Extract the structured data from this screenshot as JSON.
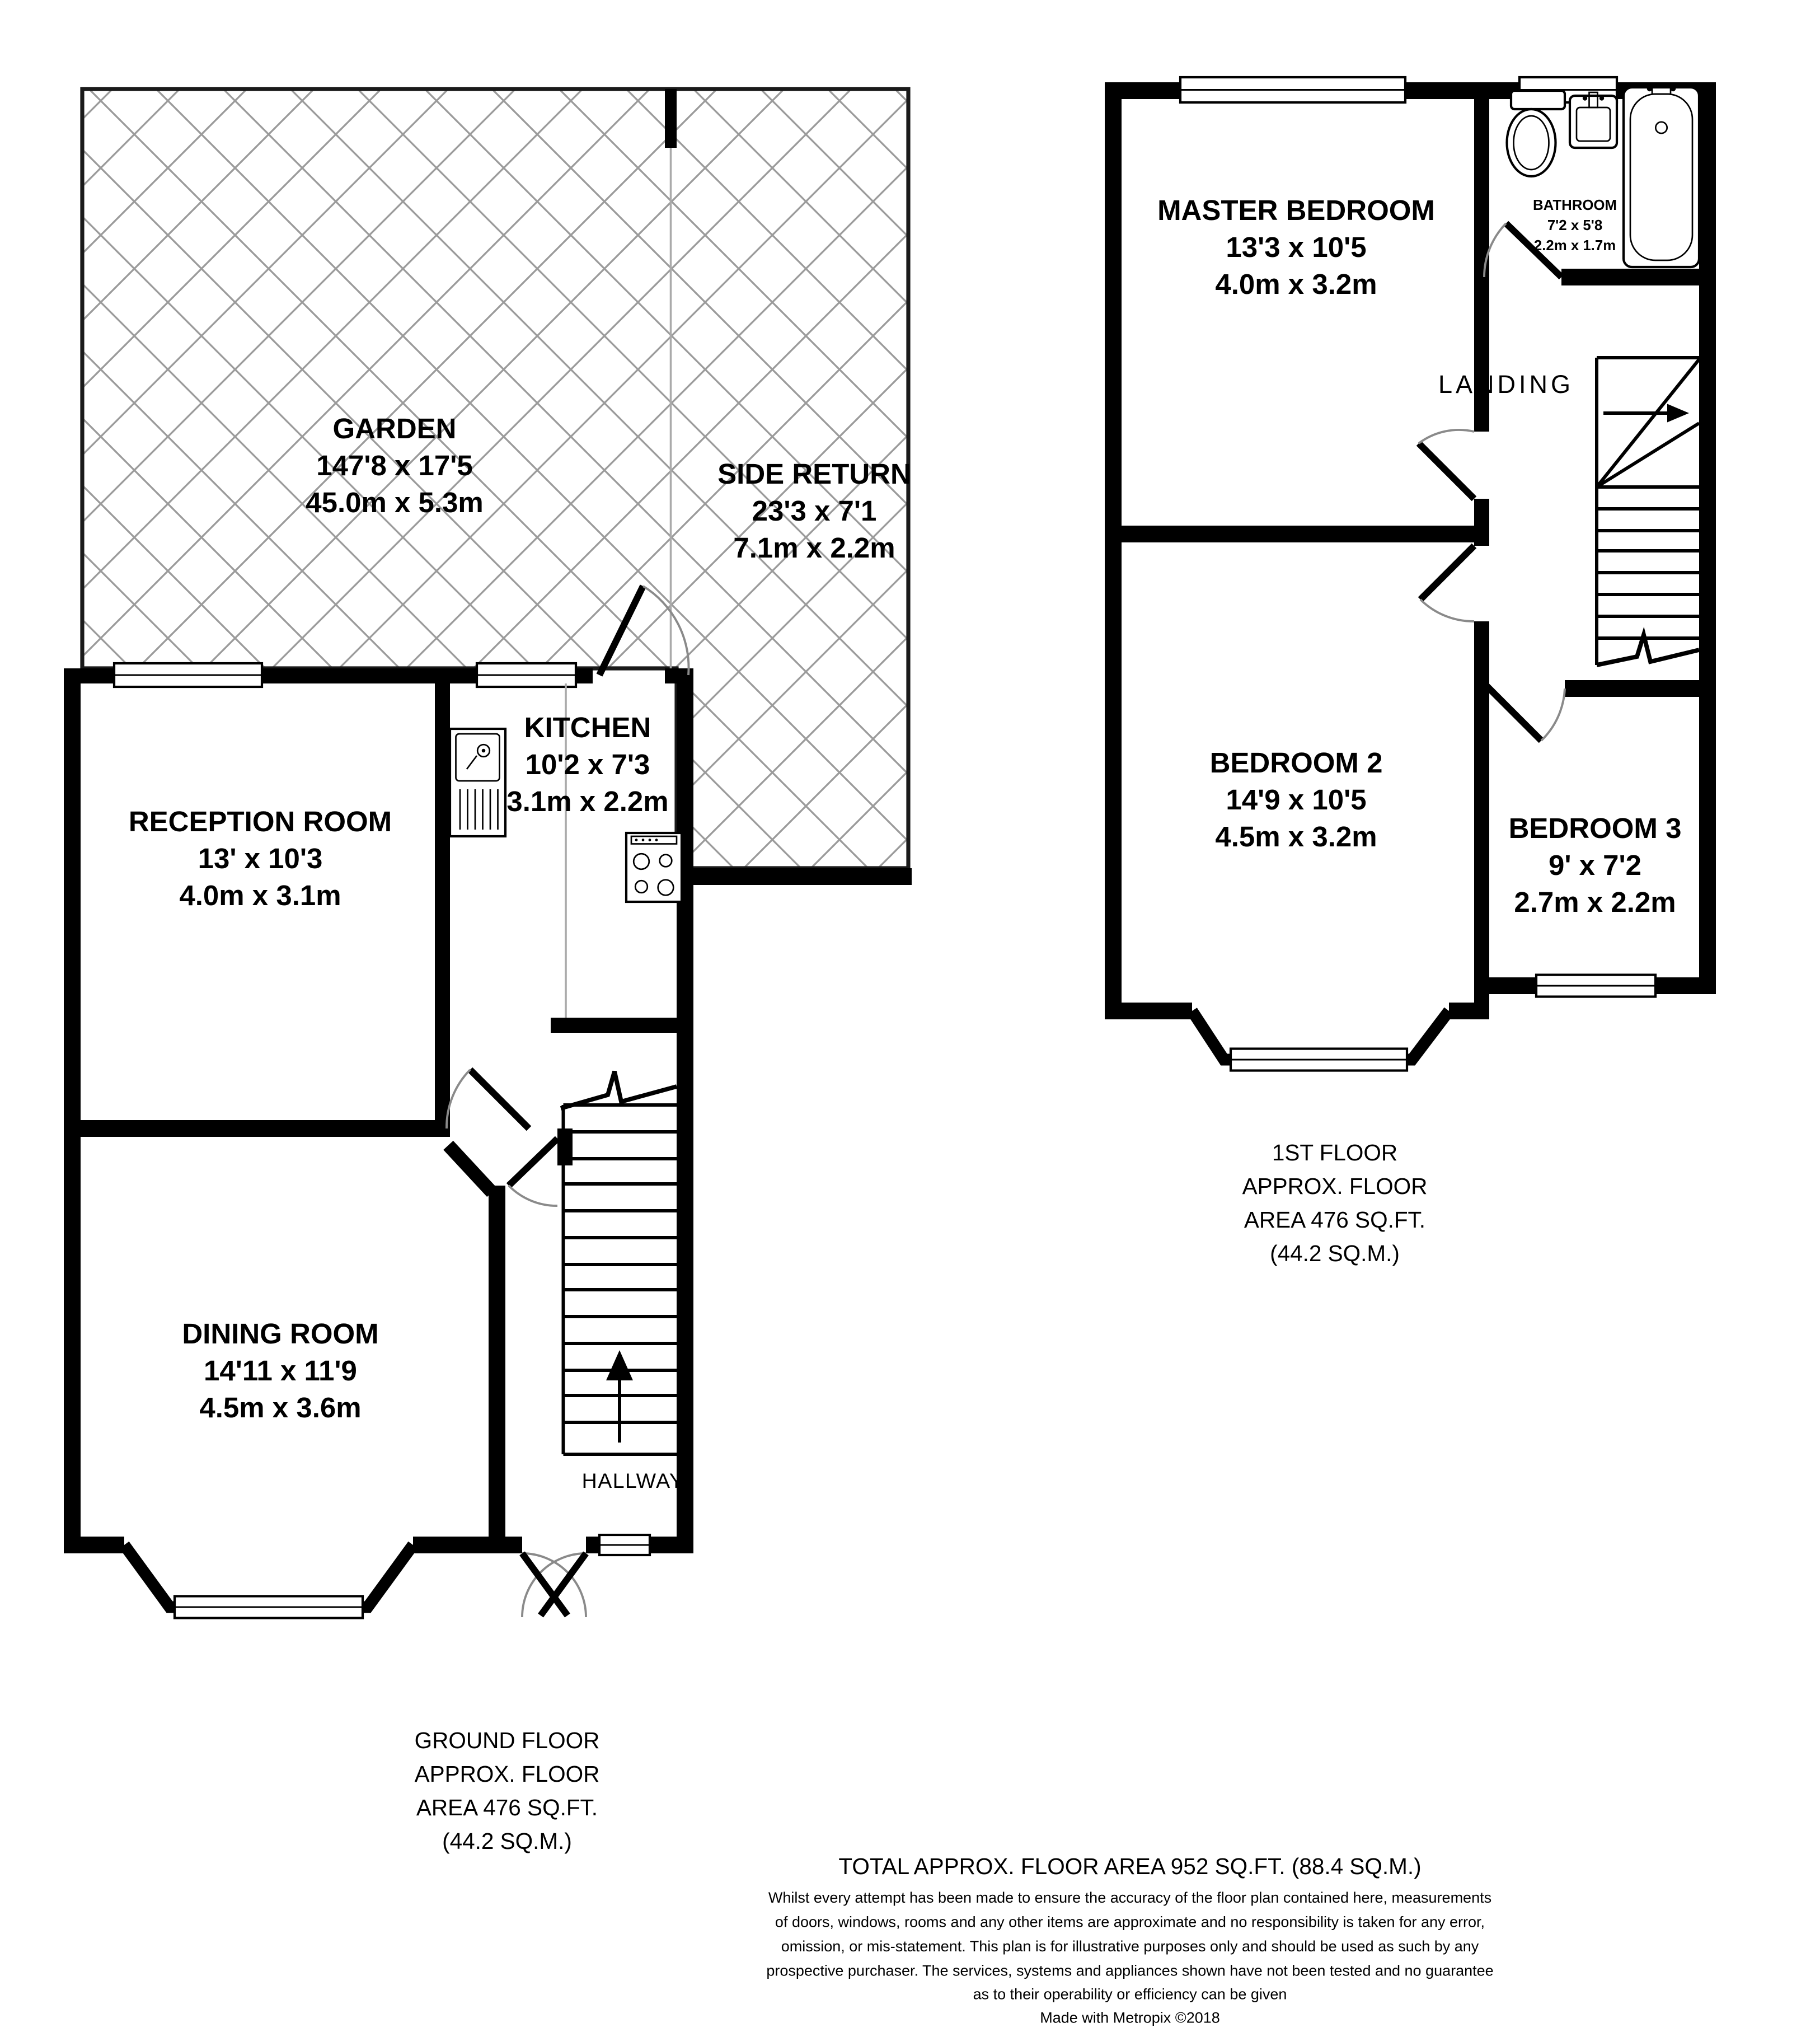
{
  "colors": {
    "wall": "#000000",
    "hatch": "#9b9b9b",
    "door_arc": "#8a8a8a",
    "background": "#ffffff"
  },
  "ground_floor": {
    "garden": {
      "name": "GARDEN",
      "imperial": "147'8 x 17'5",
      "metric": "45.0m x 5.3m"
    },
    "side_return": {
      "name": "SIDE RETURN",
      "imperial": "23'3 x 7'1",
      "metric": "7.1m x 2.2m"
    },
    "reception": {
      "name": "RECEPTION ROOM",
      "imperial": "13' x 10'3",
      "metric": "4.0m x 3.1m"
    },
    "kitchen": {
      "name": "KITCHEN",
      "imperial": "10'2 x 7'3",
      "metric": "3.1m x 2.2m"
    },
    "dining": {
      "name": "DINING ROOM",
      "imperial": "14'11 x 11'9",
      "metric": "4.5m x 3.6m"
    },
    "hallway_label": "HALLWAY",
    "note": {
      "l1": "GROUND FLOOR",
      "l2": "APPROX. FLOOR",
      "l3": "AREA 476 SQ.FT.",
      "l4": "(44.2 SQ.M.)"
    }
  },
  "first_floor": {
    "master": {
      "name": "MASTER BEDROOM",
      "imperial": "13'3 x 10'5",
      "metric": "4.0m x 3.2m"
    },
    "bathroom": {
      "name": "BATHROOM",
      "imperial": "7'2 x 5'8",
      "metric": "2.2m x 1.7m"
    },
    "landing_label": "LANDING",
    "bedroom2": {
      "name": "BEDROOM 2",
      "imperial": "14'9 x 10'5",
      "metric": "4.5m x 3.2m"
    },
    "bedroom3": {
      "name": "BEDROOM 3",
      "imperial": "9' x 7'2",
      "metric": "2.7m x 2.2m"
    },
    "note": {
      "l1": "1ST FLOOR",
      "l2": "APPROX. FLOOR",
      "l3": "AREA 476 SQ.FT.",
      "l4": "(44.2 SQ.M.)"
    }
  },
  "footer": {
    "total": "TOTAL APPROX. FLOOR AREA 952 SQ.FT. (88.4 SQ.M.)",
    "disclaimer": {
      "l1": "Whilst every attempt has been made to ensure the accuracy of the floor plan contained here, measurements",
      "l2": "of doors, windows, rooms and any other items are approximate and no responsibility is taken for any error,",
      "l3": "omission, or mis-statement. This plan is for illustrative purposes only and should be used as such by any",
      "l4": "prospective purchaser. The services, systems and appliances shown have not been tested and no guarantee",
      "l5": "as to their operability or efficiency can be given"
    },
    "credit": "Made with Metropix ©2018"
  }
}
